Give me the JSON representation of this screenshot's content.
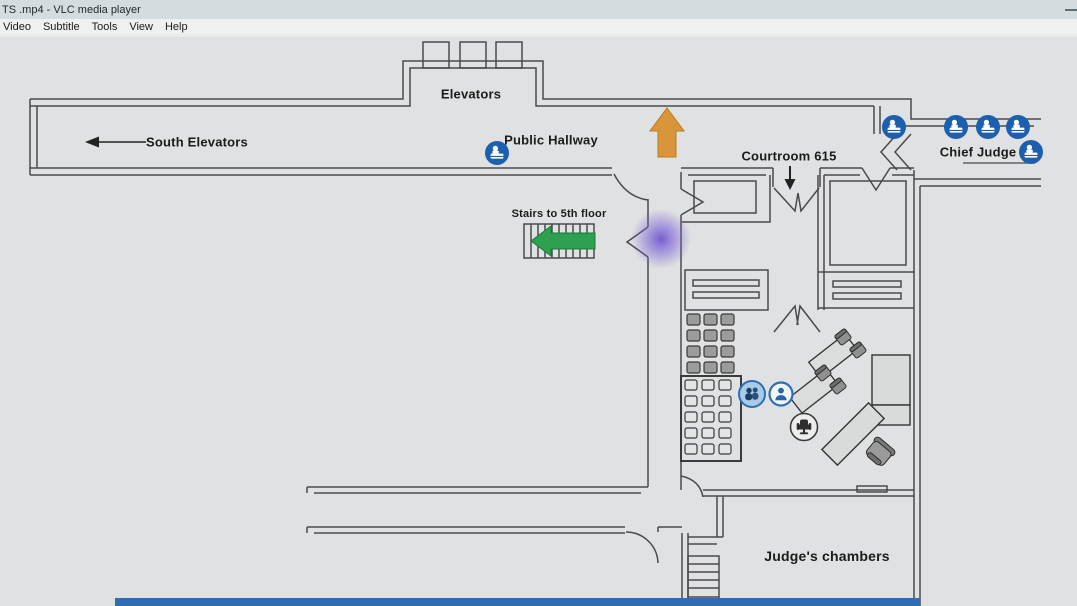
{
  "window": {
    "title": "TS .mp4 - VLC media player",
    "menu": [
      "Video",
      "Subtitle",
      "Tools",
      "View",
      "Help"
    ]
  },
  "floorplan": {
    "labels": {
      "elevators": "Elevators",
      "south_elevators": "South Elevators",
      "public_hallway": "Public Hallway",
      "stairs_to_5th_floor": "Stairs to 5th floor",
      "courtroom_615": "Courtroom 615",
      "chief_judge": "Chief Judge",
      "judges_chambers": "Judge's chambers"
    },
    "colors": {
      "badge_blue": "#1b5fae",
      "arrow_orange": "#d8953a",
      "arrow_green": "#2ea052",
      "highlight_purple": "#7a5fd6",
      "bottom_bar_blue": "#2e6cb4",
      "wall_gray": "#4a4a4d"
    }
  }
}
